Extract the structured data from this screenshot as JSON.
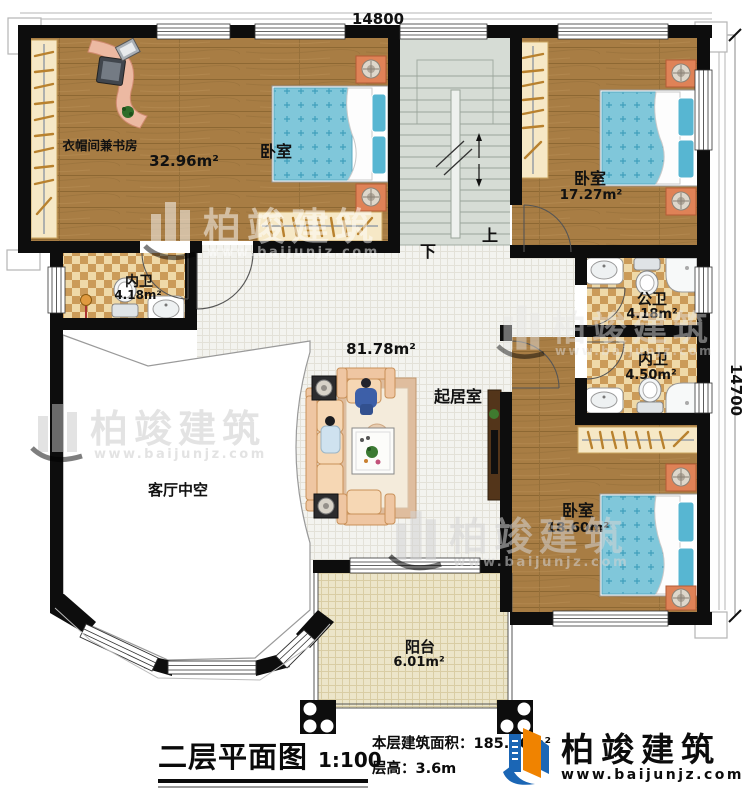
{
  "colors": {
    "wall": "#0d0d0d",
    "wood_floor": "#a87d44",
    "bed_blue": "#80c7da",
    "bath_checker": "#cb9b59",
    "brand_blue": "#1b66b5",
    "brand_orange": "#f08300"
  },
  "plan": {
    "dim_top": "14800",
    "dim_right": "14700",
    "stairs": {
      "up": "上",
      "down": "下"
    },
    "rooms": {
      "study": {
        "name": "衣帽间兼书房",
        "area": "32.96m²"
      },
      "bedroom1": {
        "name": "卧室"
      },
      "bedroom2": {
        "name": "卧室",
        "area": "17.27m²"
      },
      "bath_top": {
        "name": "内卫",
        "area": "4.18m²"
      },
      "public_bath": {
        "name": "公卫",
        "area": "4.18m²"
      },
      "bath_right": {
        "name": "内卫",
        "area": "4.50m²"
      },
      "bedroom3": {
        "name": "卧室",
        "area": "18.60m²"
      },
      "living": {
        "name": "起居室",
        "area": "81.78m²"
      },
      "void": {
        "name": "客厅中空"
      },
      "balcony": {
        "name": "阳台",
        "area": "6.01m²"
      }
    },
    "watermark": {
      "brand": "柏竣建筑",
      "url": "www.baijunjz.com"
    }
  },
  "footer": {
    "title": "二层平面图",
    "scale": "1:100",
    "area_label": "本层建筑面积：",
    "area_value": "185.86m²",
    "height_label": "层高：",
    "height_value": "3.6m",
    "brand": "柏竣建筑",
    "brand_url": "www.baijunjz.com"
  }
}
